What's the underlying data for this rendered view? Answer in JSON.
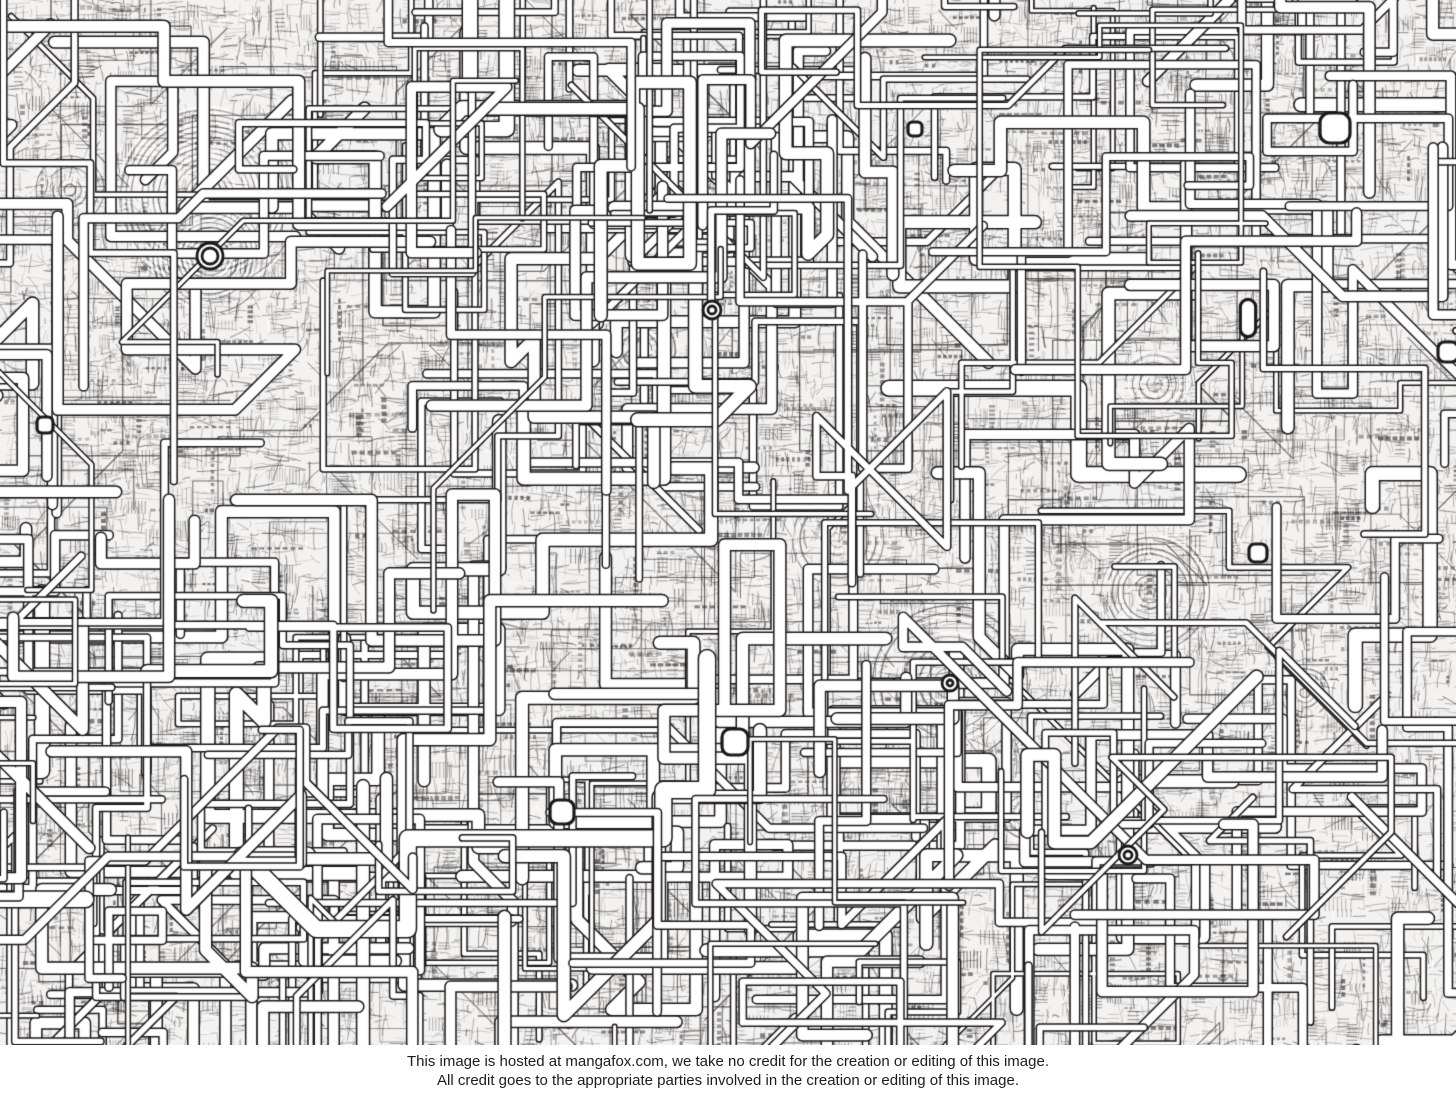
{
  "page": {
    "background": "#ffffff"
  },
  "artwork": {
    "description": "Extremely dense hand-drawn black-and-white ink artwork: a sprawling maze of white pipes and conduits with rounded corners over a mid-gray crosshatched scribble background, dotted with white squircle junction nodes, ring connectors and concentric ripple features",
    "width": 1456,
    "height": 1045,
    "seed": 1337,
    "colors": {
      "paper": "#f3f2f0",
      "ink": "#262626",
      "pipe_fill": "#ffffff",
      "pipe_outline": "#1a1a1a"
    },
    "density": {
      "hatch_strokes": 20000,
      "ladder_clusters": 1400,
      "brick_rows": 800,
      "dark_patches": 70,
      "white_flecks": 2600,
      "thin_wires": 140,
      "pipes": 150
    },
    "pipe_clusters": [
      {
        "x0": 340,
        "y0": 40,
        "x1": 780,
        "y1": 270,
        "count": 30
      },
      {
        "x0": 0,
        "y0": 700,
        "x1": 820,
        "y1": 1045,
        "count": 42
      },
      {
        "x0": 0,
        "y0": 380,
        "x1": 200,
        "y1": 920,
        "count": 16
      },
      {
        "x0": 1180,
        "y0": 40,
        "x1": 1456,
        "y1": 280,
        "count": 14
      },
      {
        "x0": 820,
        "y0": 760,
        "x1": 1220,
        "y1": 1045,
        "count": 20
      }
    ],
    "concentric_centers": [
      {
        "x": 207,
        "y": 196,
        "r": 95
      },
      {
        "x": 210,
        "y": 256,
        "r": 60
      },
      {
        "x": 950,
        "y": 683,
        "r": 78
      },
      {
        "x": 838,
        "y": 540,
        "r": 52
      },
      {
        "x": 1150,
        "y": 592,
        "r": 60
      },
      {
        "x": 70,
        "y": 190,
        "r": 38
      },
      {
        "x": 640,
        "y": 350,
        "r": 42
      }
    ],
    "nodes": [
      {
        "type": "squircle",
        "x": 1335,
        "y": 128,
        "s": 30
      },
      {
        "type": "squircle",
        "x": 735,
        "y": 742,
        "s": 26
      },
      {
        "type": "squircle",
        "x": 562,
        "y": 812,
        "s": 24
      },
      {
        "type": "squircle",
        "x": 1258,
        "y": 553,
        "s": 18
      },
      {
        "type": "squircle",
        "x": 45,
        "y": 425,
        "s": 16
      },
      {
        "type": "pill",
        "x": 1248,
        "y": 318,
        "s": 22
      },
      {
        "type": "ring",
        "x": 210,
        "y": 256,
        "r": 13
      },
      {
        "type": "ring",
        "x": 712,
        "y": 310,
        "r": 9
      },
      {
        "type": "ring",
        "x": 950,
        "y": 683,
        "r": 8
      },
      {
        "type": "ring",
        "x": 1128,
        "y": 855,
        "r": 9
      },
      {
        "type": "squircle",
        "x": 915,
        "y": 129,
        "s": 14
      },
      {
        "type": "squircle",
        "x": 1448,
        "y": 352,
        "s": 20
      }
    ]
  },
  "footer": {
    "line1": "This image is hosted at mangafox.com, we take no credit for the creation or editing of this image.",
    "line2": "All credit goes to the appropriate parties involved in the creation or editing of this image."
  }
}
